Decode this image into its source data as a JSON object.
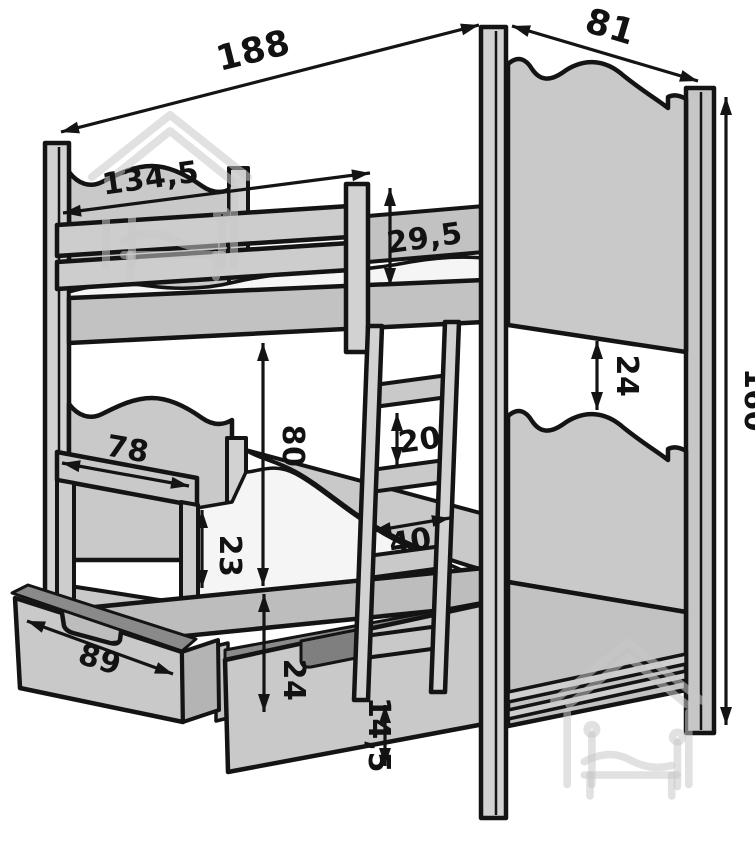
{
  "drawing": {
    "subject": "bunk bed technical dimension diagram",
    "units_visible": false
  },
  "dimensions": {
    "overall_length": "188",
    "overall_depth": "81",
    "overall_height": "160",
    "upper_guardrail_length": "134,5",
    "upper_guardrail_height": "29,5",
    "headboard_clearance": "24",
    "bunk_clearance": "80",
    "ladder_rung_gap": "20",
    "ladder_width": "40",
    "lower_guardrail_length": "78",
    "lower_guardrail_height": "23",
    "drawer_length": "89",
    "underbed_height": "24",
    "drawer_front_height": "14,5"
  },
  "colors": {
    "outline": "#141414",
    "panel": "#c9c9c9",
    "panel_light": "#d2d2d2",
    "panel_mid": "#c2c2c2",
    "panel_base": "#bdbdbd",
    "slot_dark": "#8a8a8a",
    "mattress": "#f5f5f5",
    "watermark": "#c9c9c9",
    "background": "#ffffff"
  }
}
